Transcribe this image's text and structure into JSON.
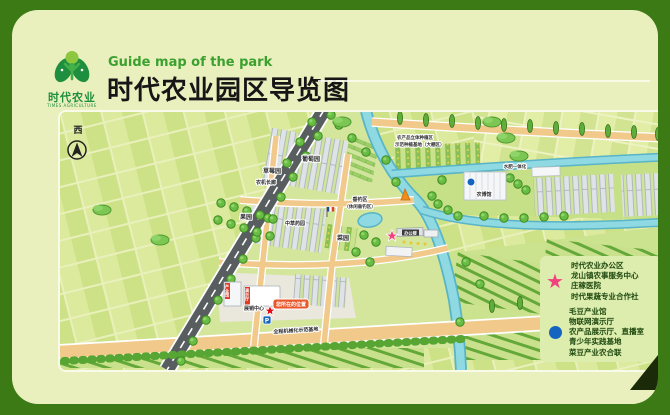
{
  "header": {
    "logo": {
      "name": "时代农业",
      "subtitle": "TIMES AGRICULTURE"
    },
    "subtitle_en": "Guide map of the park",
    "title": "时代农业园区导览图"
  },
  "map": {
    "compass": "西",
    "labels": {
      "grape": "葡萄园",
      "strawberry": "草莓园",
      "machinery_corridor": "农机长廊",
      "orchard": "果园",
      "herb_garden": "中草药园",
      "vegetable_garden": "菜园",
      "fishing_1": "垂钓区",
      "fishing_2": "（休闲垂钓区）",
      "agri_expo": "农博馆",
      "water_fertilizer": "水肥一体化",
      "crop_zone_1": "农产品立体种植区",
      "crop_zone_2": "示范种植基地（大棚区）",
      "expo_center": "展销中心",
      "office": "办公楼",
      "tag_industry_hall": "产业馆",
      "tag_demo_hall": "演示厅",
      "you_are_here": "您所在的位置",
      "mech_base": "全程机械化示范基地",
      "parking": "P"
    }
  },
  "legend": {
    "star_color": "#f0437f",
    "dot_color": "#1565c0",
    "you_are_here_color": "#e8562a",
    "star_items": [
      "时代农业办公区",
      "龙山镇农事服务中心",
      "庄稼医院",
      "时代果蔬专业合作社"
    ],
    "dot_items": [
      "毛豆产业馆",
      "物联网演示厅",
      "农产品展示厅、直播室",
      "青少年实践基地",
      "菜豆产业农合联"
    ]
  }
}
